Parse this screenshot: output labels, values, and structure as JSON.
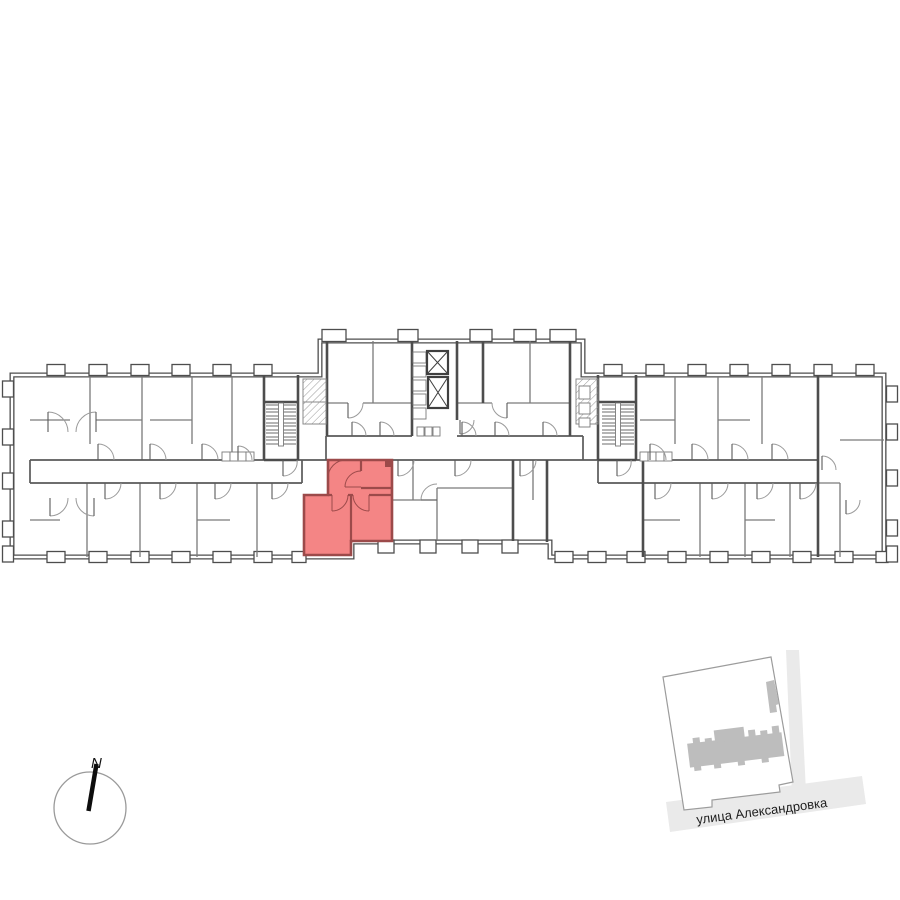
{
  "colors": {
    "highlight": "#F48585",
    "highlight-wall": "#9C4A4A",
    "wall": "#4D4D4D",
    "wall-light": "#7A7A7A",
    "road": "#EAEAEA",
    "footprint": "#BDBDBD",
    "parcel-border": "#9C9C9C"
  },
  "floor_plan": {
    "selected_unit_color": "#F48585",
    "elevator_count": 2,
    "staircase_count": 2
  },
  "compass": {
    "label": "N"
  },
  "minimap": {
    "street_label": "улица Александровка"
  }
}
